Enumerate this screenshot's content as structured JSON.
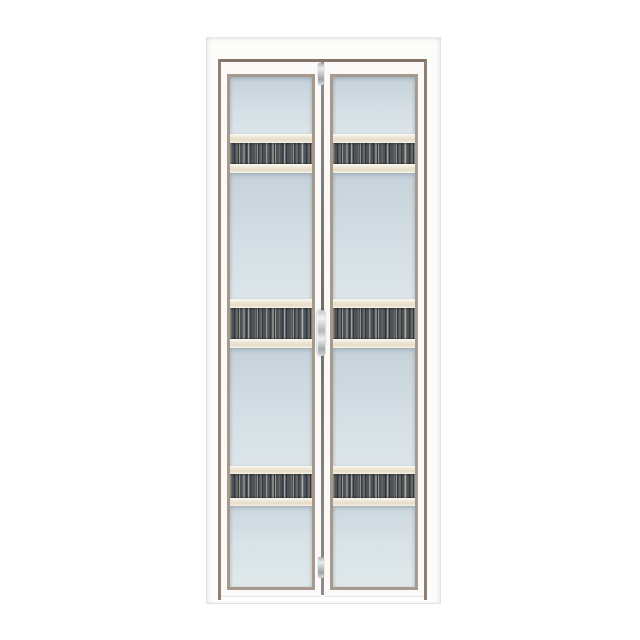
{
  "scene": {
    "type": "product-photo",
    "subject": "white aluminium bi-fold door with two folding leaves, frosted glass panels and dark wood-grain accent strips",
    "text_content": "none",
    "background_color": "#ffffff"
  },
  "door": {
    "leaves": 2,
    "glass_sections_per_leaf": 4,
    "accent_strips_per_leaf": 3,
    "hardware": [
      "top-hinge",
      "center-handle",
      "bottom-hinge"
    ],
    "colors": {
      "bg": "#ffffff",
      "frame": "#fcfcfb",
      "frame-edge": "#e3e1dd",
      "leaf": "#fbfaf8",
      "rebate": "#907f74",
      "rebate-dark": "#84746a",
      "bead": "#a79a8d",
      "glass-top": "#c6d1d9",
      "glass-mid": "#d4dee4",
      "glass-bot": "#dce5e9",
      "band": "#ebe3cf",
      "band-edge": "#fbf9f3",
      "strip": "#4c5258",
      "seam": "#716d69",
      "metal": "#c9cbcb"
    }
  }
}
